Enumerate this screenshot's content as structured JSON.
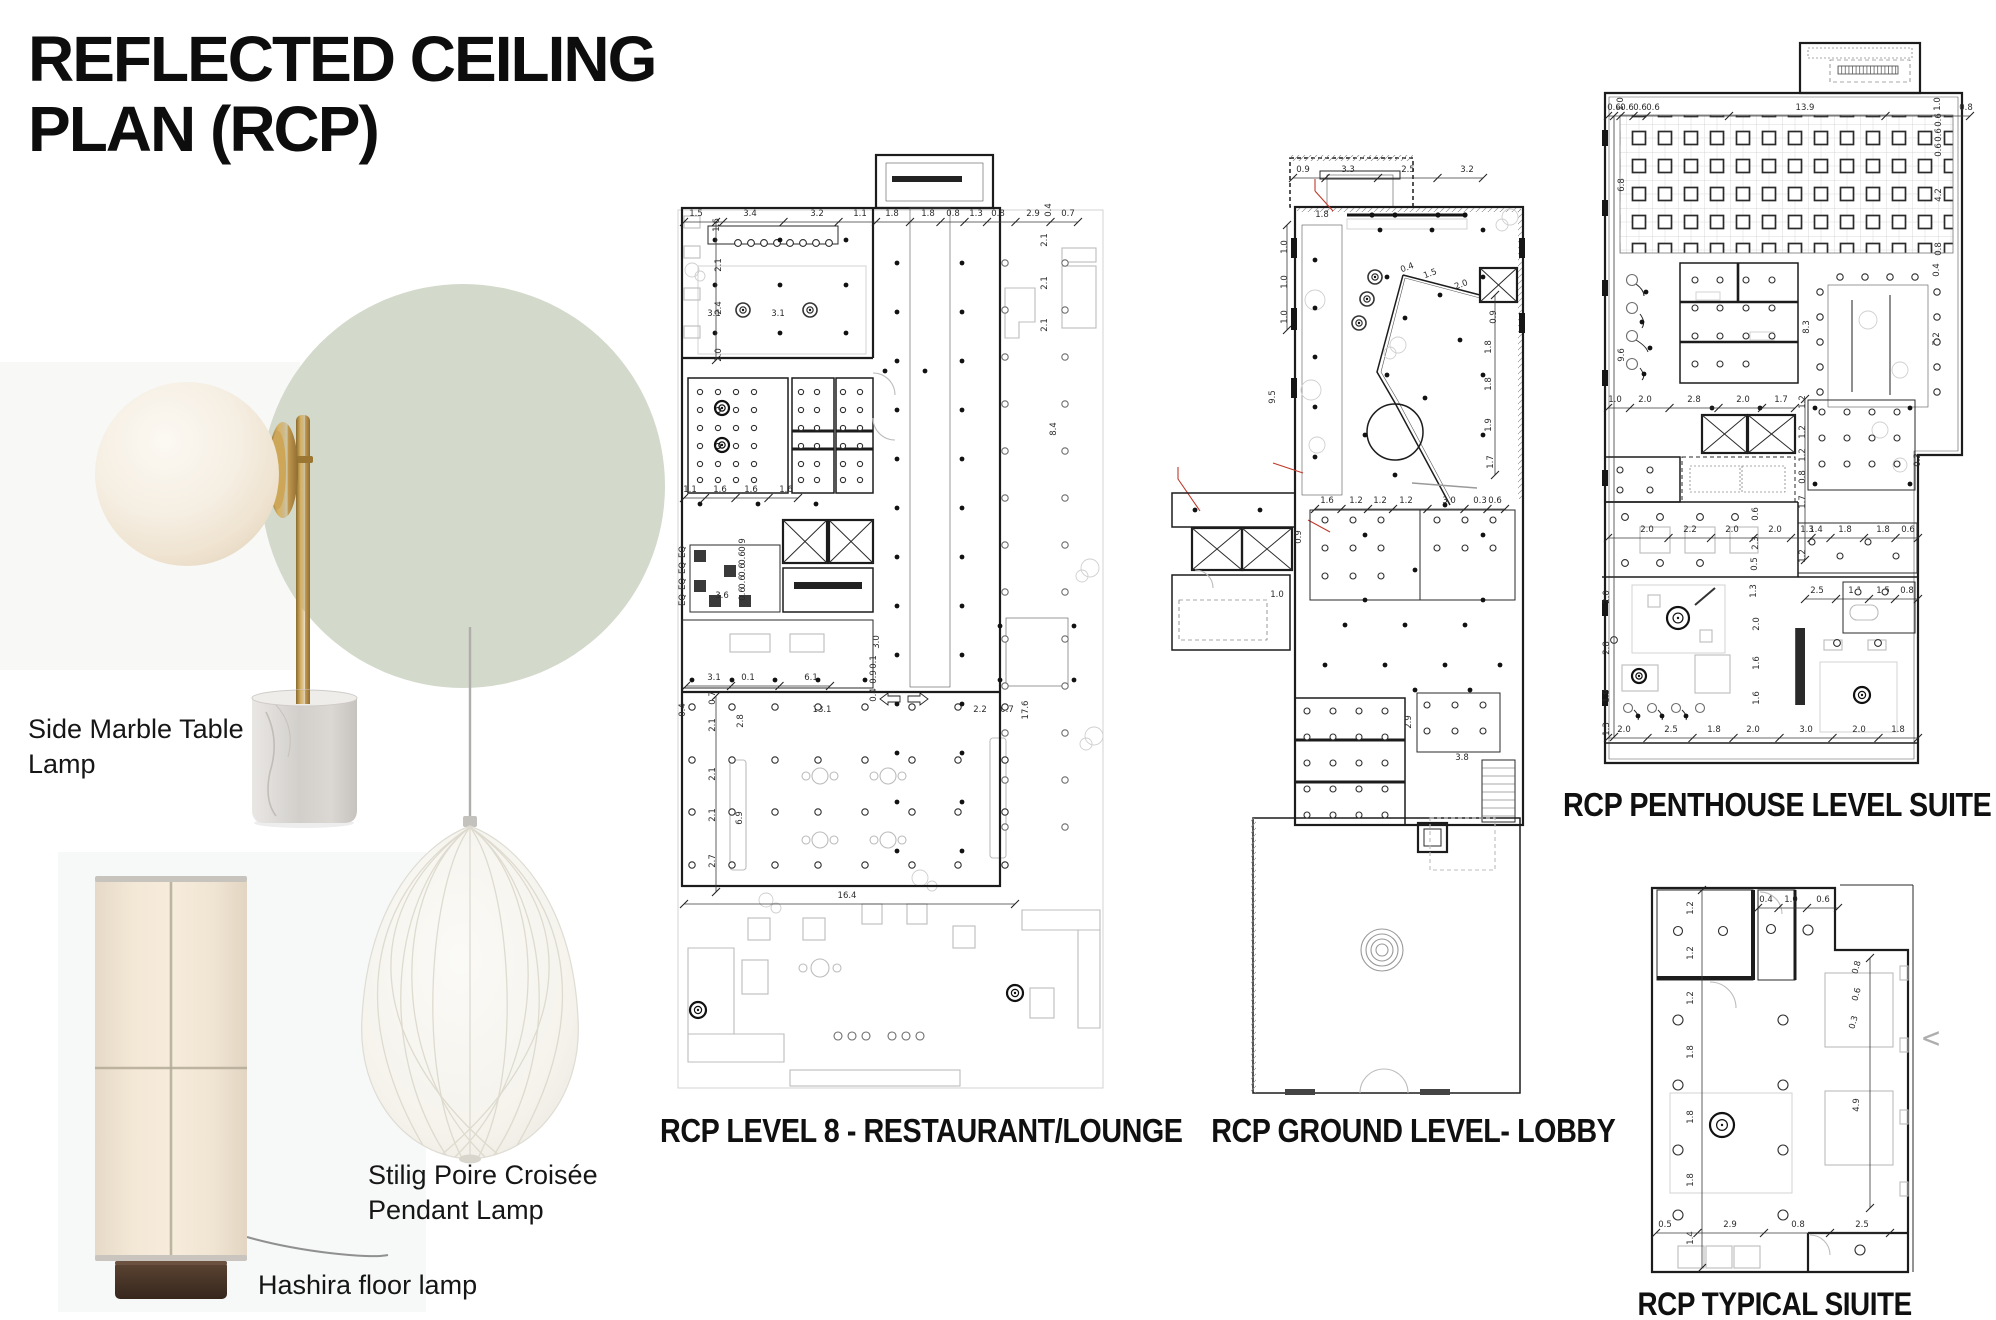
{
  "title": {
    "line1": "REFLECTED CEILING",
    "line2": "PLAN (RCP)"
  },
  "products": {
    "side_marble": {
      "line1": "Side Marble Table",
      "line2": "Lamp"
    },
    "stilig": {
      "line1": "Stilig Poire Croisée",
      "line2": "Pendant Lamp"
    },
    "hashira": {
      "line1": "Hashira floor lamp"
    }
  },
  "nav": {
    "prev_chevron": "<"
  },
  "colors": {
    "accent_circle": "#d3d9cb",
    "ink": "#0d0d0d",
    "plan_line": "#1c1c1c",
    "plan_light": "#bcbcbc",
    "annotation_red": "#c0392b",
    "brass": "#b28a42",
    "marble_base": "#d6d3cf",
    "lamp_shade": "#f3e8d8",
    "wood_base": "#4c3729"
  },
  "plans": {
    "level8": {
      "caption": "RCP LEVEL 8 - RESTAURANT/LOUNGE",
      "dims": [
        {
          "t": "1.5",
          "x": 26,
          "y": 68
        },
        {
          "t": "3.4",
          "x": 80,
          "y": 68
        },
        {
          "t": "3.2",
          "x": 147,
          "y": 68
        },
        {
          "t": "1.1",
          "x": 190,
          "y": 68
        },
        {
          "t": "1.8",
          "x": 222,
          "y": 68
        },
        {
          "t": "1.8",
          "x": 258,
          "y": 68
        },
        {
          "t": "0.8",
          "x": 283,
          "y": 68
        },
        {
          "t": "1.3",
          "x": 306,
          "y": 68
        },
        {
          "t": "0.8",
          "x": 328,
          "y": 68
        },
        {
          "t": "2.9",
          "x": 363,
          "y": 68
        },
        {
          "t": "0.7",
          "x": 398,
          "y": 68
        },
        {
          "t": "0.4",
          "x": 381,
          "y": 62,
          "r": -90
        },
        {
          "t": "1.6",
          "x": 49,
          "y": 77,
          "r": -90
        },
        {
          "t": "2.1",
          "x": 51,
          "y": 117,
          "r": -90
        },
        {
          "t": "2.4",
          "x": 51,
          "y": 160,
          "r": -90
        },
        {
          "t": "2.0",
          "x": 51,
          "y": 207,
          "r": -90
        },
        {
          "t": "3.1",
          "x": 44,
          "y": 168
        },
        {
          "t": "3.1",
          "x": 108,
          "y": 168
        },
        {
          "t": "2.1",
          "x": 377,
          "y": 92,
          "r": -90
        },
        {
          "t": "2.1",
          "x": 377,
          "y": 135,
          "r": -90
        },
        {
          "t": "2.1",
          "x": 377,
          "y": 177,
          "r": -90
        },
        {
          "t": "8.4",
          "x": 386,
          "y": 281,
          "r": -90
        },
        {
          "t": "3.1",
          "x": 44,
          "y": 532
        },
        {
          "t": "0.1",
          "x": 78,
          "y": 532
        },
        {
          "t": "6.1",
          "x": 141,
          "y": 532
        },
        {
          "t": "3.0",
          "x": 209,
          "y": 494,
          "r": -90
        },
        {
          "t": "0.1",
          "x": 206,
          "y": 514,
          "r": -90
        },
        {
          "t": "0.9",
          "x": 206,
          "y": 529,
          "r": -90
        },
        {
          "t": "0.4",
          "x": 206,
          "y": 547,
          "r": -90
        },
        {
          "t": "1.1",
          "x": 20,
          "y": 344
        },
        {
          "t": "1.6",
          "x": 50,
          "y": 344
        },
        {
          "t": "1.6",
          "x": 81,
          "y": 344
        },
        {
          "t": "1.6",
          "x": 116,
          "y": 344
        },
        {
          "t": "EQ",
          "x": 15,
          "y": 404,
          "r": -90
        },
        {
          "t": "EQ",
          "x": 15,
          "y": 420,
          "r": -90
        },
        {
          "t": "EQ",
          "x": 15,
          "y": 436,
          "r": -90
        },
        {
          "t": "EQ",
          "x": 15,
          "y": 452,
          "r": -90
        },
        {
          "t": "0.9",
          "x": 75,
          "y": 397,
          "r": -90
        },
        {
          "t": "0.6",
          "x": 75,
          "y": 410,
          "r": -90
        },
        {
          "t": "0.6",
          "x": 75,
          "y": 422,
          "r": -90
        },
        {
          "t": "0.6",
          "x": 75,
          "y": 434,
          "r": -90
        },
        {
          "t": "0.6",
          "x": 75,
          "y": 446,
          "r": -90
        },
        {
          "t": "3.6",
          "x": 52,
          "y": 450
        },
        {
          "t": "0.7",
          "x": 45,
          "y": 550,
          "r": -90
        },
        {
          "t": "2.1",
          "x": 45,
          "y": 577,
          "r": -90
        },
        {
          "t": "2.8",
          "x": 73,
          "y": 573,
          "r": -90
        },
        {
          "t": "2.1",
          "x": 45,
          "y": 626,
          "r": -90
        },
        {
          "t": "2.1",
          "x": 45,
          "y": 667,
          "r": -90
        },
        {
          "t": "6.9",
          "x": 72,
          "y": 670,
          "r": -90
        },
        {
          "t": "2.7",
          "x": 45,
          "y": 713,
          "r": -90
        },
        {
          "t": "0.4",
          "x": 15,
          "y": 562,
          "r": -90
        },
        {
          "t": "13.1",
          "x": 152,
          "y": 564
        },
        {
          "t": "2.2",
          "x": 310,
          "y": 564
        },
        {
          "t": "0.7",
          "x": 337,
          "y": 564
        },
        {
          "t": "17.6",
          "x": 358,
          "y": 562,
          "r": -90
        },
        {
          "t": "16.4",
          "x": 177,
          "y": 750
        }
      ]
    },
    "lobby": {
      "caption": "RCP GROUND LEVEL- LOBBY",
      "dims": [
        {
          "t": "0.9",
          "x": 138,
          "y": 27
        },
        {
          "t": "3.3",
          "x": 183,
          "y": 27
        },
        {
          "t": "2.5",
          "x": 243,
          "y": 27
        },
        {
          "t": "3.2",
          "x": 302,
          "y": 27
        },
        {
          "t": "1.8",
          "x": 157,
          "y": 72
        },
        {
          "t": "1.0",
          "x": 122,
          "y": 102,
          "r": -90
        },
        {
          "t": "1.0",
          "x": 122,
          "y": 137,
          "r": -90
        },
        {
          "t": "1.0",
          "x": 122,
          "y": 172,
          "r": -90
        },
        {
          "t": "9.5",
          "x": 110,
          "y": 252,
          "r": -90
        },
        {
          "t": "0.4",
          "x": 243,
          "y": 125,
          "r": -20
        },
        {
          "t": "1.5",
          "x": 266,
          "y": 131,
          "r": -20
        },
        {
          "t": "2.0",
          "x": 297,
          "y": 142,
          "r": -20
        },
        {
          "t": "0.9",
          "x": 331,
          "y": 172,
          "r": -90
        },
        {
          "t": "1.8",
          "x": 326,
          "y": 202,
          "r": -90
        },
        {
          "t": "1.8",
          "x": 326,
          "y": 239,
          "r": -90
        },
        {
          "t": "1.9",
          "x": 326,
          "y": 280,
          "r": -90
        },
        {
          "t": "1.7",
          "x": 328,
          "y": 317,
          "r": -90
        },
        {
          "t": "1.6",
          "x": 162,
          "y": 358
        },
        {
          "t": "1.2",
          "x": 191,
          "y": 358
        },
        {
          "t": "1.2",
          "x": 215,
          "y": 358
        },
        {
          "t": "1.2",
          "x": 241,
          "y": 358
        },
        {
          "t": "3.0",
          "x": 284,
          "y": 358
        },
        {
          "t": "0.3",
          "x": 315,
          "y": 358
        },
        {
          "t": "0.6",
          "x": 330,
          "y": 358
        },
        {
          "t": "0.9",
          "x": 136,
          "y": 392,
          "r": -90
        },
        {
          "t": "1.0",
          "x": 112,
          "y": 452
        },
        {
          "t": "2.9",
          "x": 246,
          "y": 577,
          "r": -90
        },
        {
          "t": "3.8",
          "x": 297,
          "y": 615
        }
      ]
    },
    "penthouse": {
      "caption": "RCP PENTHOUSE LEVEL SUITE",
      "dims": [
        {
          "t": "0.6",
          "x": 14,
          "y": 70
        },
        {
          "t": "0.6",
          "x": 27,
          "y": 70
        },
        {
          "t": "0.6",
          "x": 40,
          "y": 70
        },
        {
          "t": "0.6",
          "x": 53,
          "y": 70
        },
        {
          "t": "13.9",
          "x": 205,
          "y": 70
        },
        {
          "t": "0.8",
          "x": 366,
          "y": 70
        },
        {
          "t": "1.0",
          "x": 23,
          "y": 64,
          "r": -90
        },
        {
          "t": "1.0",
          "x": 340,
          "y": 64,
          "r": -90
        },
        {
          "t": "6.8",
          "x": 24,
          "y": 145,
          "r": -90
        },
        {
          "t": "0.6",
          "x": 341,
          "y": 80,
          "r": -90
        },
        {
          "t": "0.6",
          "x": 341,
          "y": 95,
          "r": -90
        },
        {
          "t": "0.6",
          "x": 341,
          "y": 110,
          "r": -90
        },
        {
          "t": "4.2",
          "x": 341,
          "y": 155,
          "r": -90
        },
        {
          "t": "0.8",
          "x": 341,
          "y": 209,
          "r": -90
        },
        {
          "t": "0.4",
          "x": 339,
          "y": 230,
          "r": -90
        },
        {
          "t": "9.6",
          "x": 24,
          "y": 315,
          "r": -90
        },
        {
          "t": "8.3",
          "x": 209,
          "y": 287,
          "r": -90
        },
        {
          "t": "7.2",
          "x": 339,
          "y": 299,
          "r": -90
        },
        {
          "t": "1.0",
          "x": 15,
          "y": 362
        },
        {
          "t": "2.0",
          "x": 45,
          "y": 362
        },
        {
          "t": "2.8",
          "x": 94,
          "y": 362
        },
        {
          "t": "2.0",
          "x": 143,
          "y": 362
        },
        {
          "t": "1.7",
          "x": 181,
          "y": 362
        },
        {
          "t": "1.2",
          "x": 205,
          "y": 362,
          "r": -90
        },
        {
          "t": "1.2",
          "x": 205,
          "y": 392,
          "r": -90
        },
        {
          "t": "1.2",
          "x": 205,
          "y": 415,
          "r": -90
        },
        {
          "t": "0.8",
          "x": 205,
          "y": 437,
          "r": -90
        },
        {
          "t": "1.7",
          "x": 205,
          "y": 462,
          "r": -90
        },
        {
          "t": "2.0",
          "x": 47,
          "y": 492
        },
        {
          "t": "2.2",
          "x": 90,
          "y": 492
        },
        {
          "t": "2.0",
          "x": 132,
          "y": 492
        },
        {
          "t": "2.0",
          "x": 175,
          "y": 492
        },
        {
          "t": "0.6",
          "x": 158,
          "y": 474,
          "r": -90
        },
        {
          "t": "2.3",
          "x": 158,
          "y": 503,
          "r": -90
        },
        {
          "t": "0.5",
          "x": 157,
          "y": 524,
          "r": -90
        },
        {
          "t": "1.3",
          "x": 207,
          "y": 492
        },
        {
          "t": "1.4",
          "x": 216,
          "y": 492
        },
        {
          "t": "1.8",
          "x": 245,
          "y": 492
        },
        {
          "t": "1.8",
          "x": 283,
          "y": 492
        },
        {
          "t": "0.6",
          "x": 308,
          "y": 492
        },
        {
          "t": "1.2",
          "x": 205,
          "y": 516,
          "r": -90
        },
        {
          "t": "2.5",
          "x": 217,
          "y": 553
        },
        {
          "t": "1.1",
          "x": 255,
          "y": 553
        },
        {
          "t": "1.5",
          "x": 283,
          "y": 553
        },
        {
          "t": "0.8",
          "x": 307,
          "y": 553
        },
        {
          "t": "2.0",
          "x": 9,
          "y": 557,
          "r": -90
        },
        {
          "t": "2.8",
          "x": 9,
          "y": 608,
          "r": -90
        },
        {
          "t": "1.9",
          "x": 9,
          "y": 656,
          "r": -90
        },
        {
          "t": "1.3",
          "x": 9,
          "y": 689,
          "r": -90
        },
        {
          "t": "1.3",
          "x": 156,
          "y": 551,
          "r": -90
        },
        {
          "t": "2.0",
          "x": 159,
          "y": 584,
          "r": -90
        },
        {
          "t": "1.6",
          "x": 159,
          "y": 623,
          "r": -90
        },
        {
          "t": "1.6",
          "x": 159,
          "y": 658,
          "r": -90
        },
        {
          "t": "2.0",
          "x": 24,
          "y": 692
        },
        {
          "t": "2.5",
          "x": 71,
          "y": 692
        },
        {
          "t": "1.8",
          "x": 114,
          "y": 692
        },
        {
          "t": "2.0",
          "x": 153,
          "y": 692
        },
        {
          "t": "3.0",
          "x": 206,
          "y": 692
        },
        {
          "t": "2.0",
          "x": 259,
          "y": 692
        },
        {
          "t": "1.8",
          "x": 298,
          "y": 692
        },
        {
          "t": "0.3",
          "x": 320,
          "y": 420,
          "r": -90
        }
      ]
    },
    "suite": {
      "caption": "RCP TYPICAL SIUITE",
      "dims": [
        {
          "t": "0.4",
          "x": 116,
          "y": 24
        },
        {
          "t": "1.0",
          "x": 141,
          "y": 24
        },
        {
          "t": "0.6",
          "x": 173,
          "y": 24
        },
        {
          "t": "1.2",
          "x": 43,
          "y": 30,
          "r": -90
        },
        {
          "t": "1.2",
          "x": 43,
          "y": 75,
          "r": -90
        },
        {
          "t": "1.2",
          "x": 43,
          "y": 120,
          "r": -90
        },
        {
          "t": "1.8",
          "x": 43,
          "y": 174,
          "r": -90
        },
        {
          "t": "1.8",
          "x": 43,
          "y": 239,
          "r": -90
        },
        {
          "t": "1.8",
          "x": 43,
          "y": 302,
          "r": -90
        },
        {
          "t": "1.4",
          "x": 43,
          "y": 360,
          "r": -90
        },
        {
          "t": "0.8",
          "x": 209,
          "y": 90,
          "r": -75
        },
        {
          "t": "0.6",
          "x": 209,
          "y": 117,
          "r": -75
        },
        {
          "t": "0.3",
          "x": 206,
          "y": 145,
          "r": -75
        },
        {
          "t": "4.9",
          "x": 209,
          "y": 227,
          "r": -90
        },
        {
          "t": "0.5",
          "x": 15,
          "y": 349
        },
        {
          "t": "2.9",
          "x": 80,
          "y": 349
        },
        {
          "t": "0.8",
          "x": 148,
          "y": 349
        },
        {
          "t": "2.5",
          "x": 212,
          "y": 349
        }
      ]
    }
  }
}
